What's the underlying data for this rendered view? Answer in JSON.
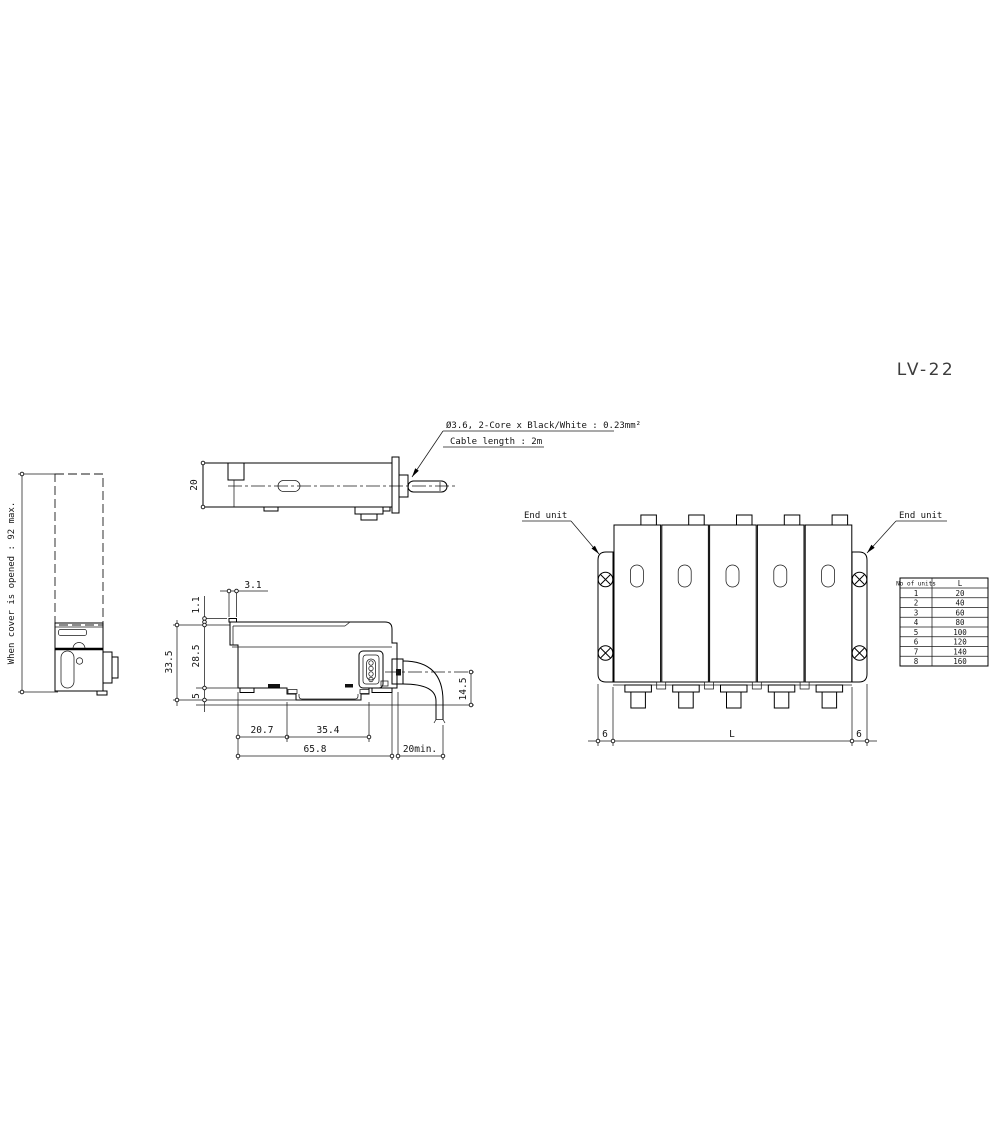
{
  "title": "LV-22",
  "left_view": {
    "cover_dim_label": "When cover is opened : 92 max."
  },
  "top_view": {
    "height_dim": "20",
    "cable_note_line1": "Ø3.6, 2-Core x Black/White : 0.23mm²",
    "cable_note_line2": "Cable length : 2m"
  },
  "side_view": {
    "dims": {
      "tab_width": "3.1",
      "tab_height": "1.1",
      "overall_height": "33.5",
      "body_height": "28.5",
      "base_height": "5",
      "front_to_slot": "20.7",
      "slot_width": "35.4",
      "overall_length": "65.8",
      "bend_radius": "20min.",
      "cable_drop": "14.5"
    }
  },
  "assembly_view": {
    "end_unit_left_label": "End unit",
    "end_unit_right_label": "End unit",
    "dim_end_left": "6",
    "dim_span": "L",
    "dim_end_right": "6"
  },
  "units_table": {
    "headers": [
      "No of units",
      "L"
    ],
    "rows": [
      [
        "1",
        "20"
      ],
      [
        "2",
        "40"
      ],
      [
        "3",
        "60"
      ],
      [
        "4",
        "80"
      ],
      [
        "5",
        "100"
      ],
      [
        "6",
        "120"
      ],
      [
        "7",
        "140"
      ],
      [
        "8",
        "160"
      ]
    ]
  }
}
